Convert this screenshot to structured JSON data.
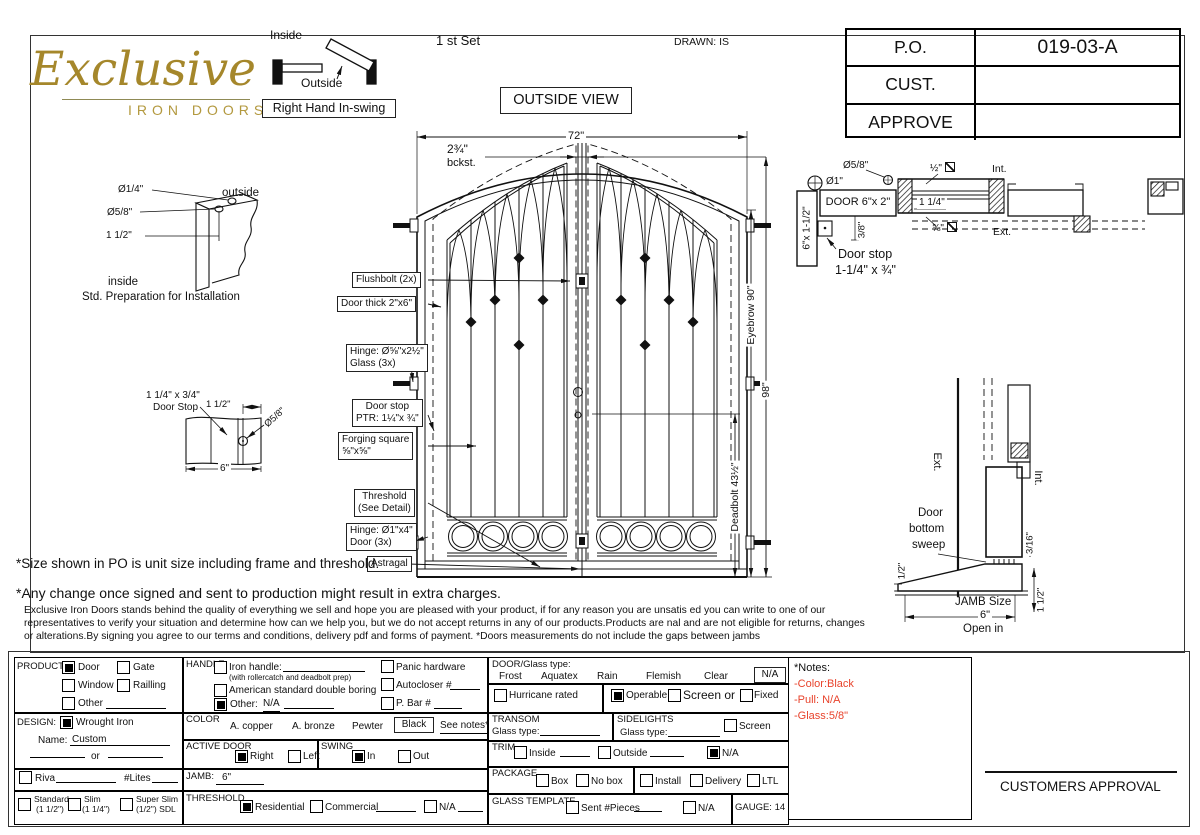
{
  "title_block": {
    "po_label": "P.O.",
    "po_value": "019-03-A",
    "cust_label": "CUST.",
    "approve_label": "APPROVE"
  },
  "header": {
    "logo_script": "Exclusive",
    "logo_sub": "IRON DOORS",
    "set_label": "1 st Set",
    "drawn_label": "DRAWN: IS",
    "view_label": "OUTSIDE VIEW",
    "swing_inside": "Inside",
    "swing_outside": "Outside",
    "swing_label": "Right Hand In-swing"
  },
  "std_prep": {
    "dia_quarter": "Ø1/4\"",
    "dia_five_eighths": "Ø5/8\"",
    "one_half": "1 1/2\"",
    "outside": "outside",
    "inside": "inside",
    "caption": "Std. Preparation for Installation"
  },
  "stop_detail": {
    "size": "1 1/4\" x 3/4\"",
    "name": "Door Stop",
    "one_half": "1 1/2\"",
    "dia": "Ø5/8\"",
    "width": "6\""
  },
  "door": {
    "dim_width": "72\"",
    "backset": "2¾\"",
    "backset_sub": "bckst.",
    "flushbolt": "Flushbolt (2x)",
    "door_thick": "Door thick 2\"x6\"",
    "hinge_glass_1": "Hinge: Ø⅝\"x2½\"",
    "hinge_glass_2": "Glass (3x)",
    "door_stop_1": "Door stop",
    "door_stop_2": "PTR: 1¼\"x ¾\"",
    "forging_1": "Forging square",
    "forging_2": "⅝\"x⅝\"",
    "threshold_1": "Threshold",
    "threshold_2": "(See Detail)",
    "hinge_door_1": "Hinge: Ø1\"x4\"",
    "hinge_door_2": "Door (3x)",
    "astragal": "Astragal",
    "dim_eyebrow": "Eyebrow 90\"",
    "dim_height": "98\"",
    "dim_deadbolt": "Deadbolt 43½\""
  },
  "head_section": {
    "dia_one": "Ø1\"",
    "dia_58": "Ø5/8\"",
    "door_size": "DOOR 6\"x 2\"",
    "jamb_size": "6\"x 1-1/2\"",
    "glass_half": "½\"",
    "interior": "Int.",
    "dim_114": "1 1/4\"",
    "glass_58": "⅝\"",
    "exterior": "Ext.",
    "dim_38": "3/8\"",
    "stop_1": "Door stop",
    "stop_2": "1-1/4\" x ¾\""
  },
  "sill_section": {
    "exterior": "Ext.",
    "interior": "Int.",
    "sweep_1": "Door",
    "sweep_2": "bottom",
    "sweep_3": "sweep",
    "dim_half": "1/2\"",
    "dim_316": "3/16\"",
    "dim_112": "1 1/2\"",
    "jamb_label": "JAMB Size",
    "jamb_value": "6\"",
    "open_label": "Open in"
  },
  "disclaimer": {
    "line1": "*Size shown in PO is unit size including frame and threshold.",
    "line2": "*Any change once signed and sent to production might result in extra charges.",
    "body1": "Exclusive Iron Doors stands behind the quality of everything we sell and hope you are pleased with your product, if for any reason you are unsatis   ed you can write to one of our",
    "body2": "representatives to verify your situation and determine how can we help you, but we do not accept returns in any of our products.Products are    nal and are not eligible for returns, changes",
    "body3": "or alterations.By signing you agree to our terms and conditions, delivery pdf and forms of payment. *Doors measurements do not include the gaps between jambs"
  },
  "form": {
    "product": {
      "label": "PRODUCT:",
      "door": "Door",
      "gate": "Gate",
      "window": "Window",
      "railing": "Railling",
      "other": "Other",
      "selected": "Door"
    },
    "handle": {
      "label": "HANDLE",
      "iron": "Iron handle:",
      "iron_sub": "(with rollercatch and deadbolt prep)",
      "american": "American standard double boring",
      "other": "Other:",
      "other_value": "N/A",
      "panic": "Panic hardware",
      "autocloser": "Autocloser #",
      "pbar": "P. Bar #",
      "selected": "Other"
    },
    "design": {
      "label": "DESIGN:",
      "wrought": "Wrought Iron",
      "name_label": "Name:",
      "name_value": "Custom",
      "or_label": "or",
      "riva": "Riva",
      "lites": "#Lites",
      "standard": "Standard",
      "standard_size": "(1 1/2\")",
      "slim": "Slim",
      "slim_size": "(1 1/4\")",
      "super_slim": "Super Slim",
      "super_slim_size": "(1/2\") SDL",
      "selected": "Wrought Iron"
    },
    "color": {
      "label": "COLOR",
      "copper": "A. copper",
      "bronze": "A. bronze",
      "pewter": "Pewter",
      "black": "Black",
      "see_notes": "See notes*",
      "selected": "Black"
    },
    "active_door": {
      "label": "ACTIVE DOOR",
      "right": "Right",
      "left": "Left",
      "selected": "Right"
    },
    "swing": {
      "label": "SWING",
      "in": "In",
      "out": "Out",
      "selected": "In"
    },
    "jamb": {
      "label": "JAMB:",
      "value": "6\""
    },
    "threshold": {
      "label": "THRESHOLD",
      "residential": "Residential",
      "commercial": "Commercial",
      "na": "N/A",
      "selected": "Residential"
    },
    "glass": {
      "label": "DOOR/Glass type:",
      "frost": "Frost",
      "aquatex": "Aquatex",
      "rain": "Rain",
      "flemish": "Flemish",
      "clear": "Clear",
      "na": "N/A",
      "selected": "N/A",
      "hurricane": "Hurricane rated",
      "operable": "Operable",
      "screen_or": "Screen or",
      "fixed": "Fixed",
      "operation_selected": "Operable"
    },
    "transom": {
      "label": "TRANSOM",
      "glass_type": "Glass type:"
    },
    "sidelights": {
      "label": "SIDELIGHTS",
      "glass_type": "Glass type:",
      "screen": "Screen"
    },
    "trim": {
      "label": "TRIM",
      "inside": "Inside",
      "outside": "Outside",
      "na": "N/A",
      "selected": "N/A"
    },
    "package": {
      "label": "PACKAGE",
      "box": "Box",
      "no_box": "No box",
      "install": "Install",
      "delivery": "Delivery",
      "ltl": "LTL"
    },
    "glass_template": {
      "label": "GLASS TEMPLATE",
      "sent": "Sent #Pieces",
      "na": "N/A"
    },
    "gauge": "GAUGE: 14",
    "notes": {
      "title": "*Notes:",
      "line1": "-Color:Black",
      "line2": "-Pull: N/A",
      "line3": "-Glass:5/8\""
    },
    "approval": "CUSTOMERS APPROVAL"
  },
  "colors": {
    "logo_gold": "#A5872B",
    "note_red": "#E8432C",
    "line": "#1A1A1A"
  }
}
